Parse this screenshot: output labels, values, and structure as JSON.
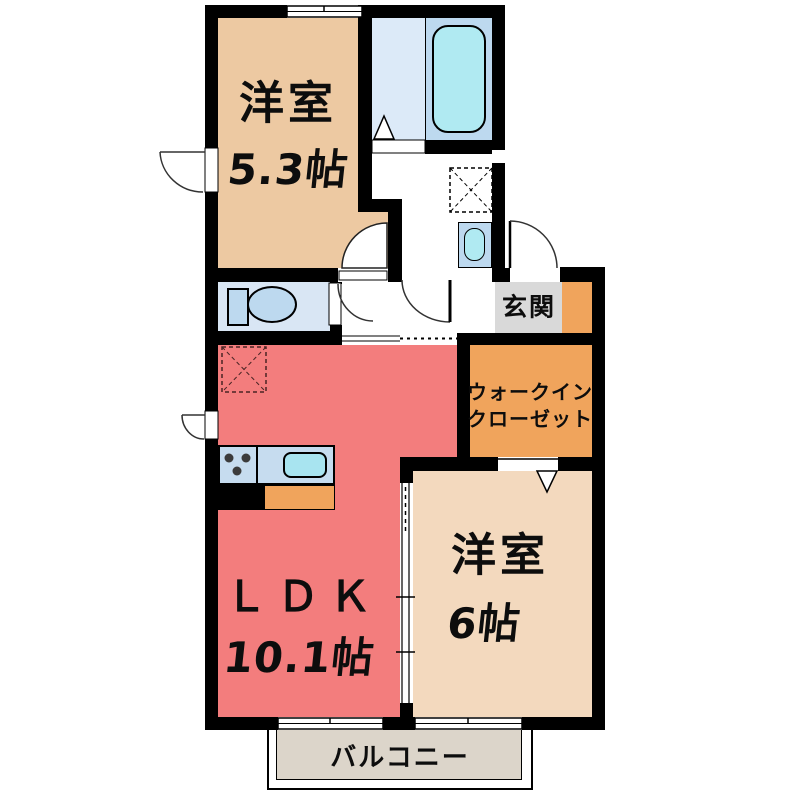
{
  "floorplan": {
    "rooms": {
      "bedroom1": {
        "name": "洋室",
        "size": "5.3帖",
        "color": "#EDC9A2"
      },
      "ldk": {
        "name": "ＬＤＫ",
        "size": "10.1帖",
        "color": "#F37D7D"
      },
      "bedroom2": {
        "name": "洋室",
        "size": "6帖",
        "color": "#F3D9BE"
      },
      "walkin_closet": {
        "name_line1": "ウォークイン",
        "name_line2": "クローゼット",
        "color": "#F0A45C"
      },
      "entrance": {
        "name": "玄関",
        "color": "#D9D9D9"
      },
      "balcony": {
        "name": "バルコニー",
        "color": "#DCD5CA"
      },
      "bathroom": {
        "color": "#DCEAF8"
      },
      "toilet_room": {
        "color": "#D9E6F4"
      }
    },
    "fixtures": {
      "bathtub": "bathtub",
      "washbasin": "washbasin",
      "toilet": "toilet",
      "kitchen_counter": "kitchen-counter",
      "stove": "stove",
      "sink": "sink",
      "washing_machine_space": "washing-machine-space",
      "refrigerator_space": "refrigerator-space",
      "shoe_cabinet": "shoe-cabinet"
    },
    "colors": {
      "wall": "#000000",
      "fixture_blue": "#BDD9EF",
      "water_cyan": "#B0EAF2",
      "counter_blue": "#C6DCEF",
      "sink_cyan": "#A8E4F0",
      "accent_orange": "#F0A45C",
      "entrance_gray": "#D9D9D9",
      "balcony_gray": "#DCD5CA"
    }
  }
}
